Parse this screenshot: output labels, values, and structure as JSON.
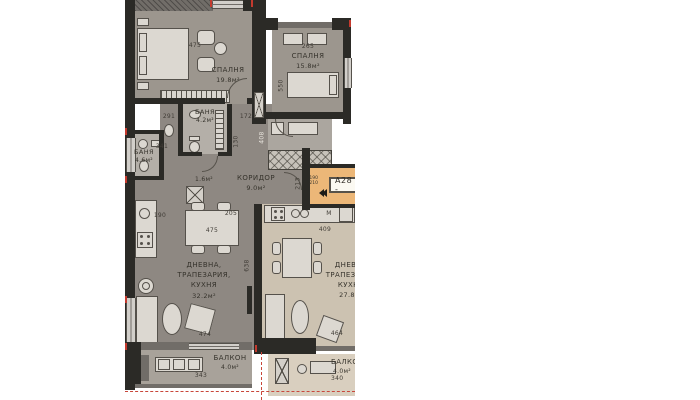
{
  "unit": {
    "badge": "А28 -",
    "entry_door_width": "190",
    "entry_door_height": "210"
  },
  "rooms": {
    "bedroom_left": {
      "name": "СПАЛНЯ",
      "area": "19.8м²"
    },
    "bedroom_right": {
      "name": "СПАЛНЯ",
      "area": "15.8м²"
    },
    "bath_top": {
      "name": "БАНЯ",
      "area": "4.2м²"
    },
    "bath_left": {
      "name": "БАНЯ",
      "area": "4.6м²"
    },
    "corridor": {
      "name": "КОРИДОР",
      "area": "9.0м²"
    },
    "closet": {
      "area": "1.6м²"
    },
    "living_left": {
      "l1": "ДНЕВНА,",
      "l2": "ТРАПЕЗАРИЯ,",
      "l3": "КУХНЯ",
      "area": "32.2м²"
    },
    "living_right": {
      "l1": "ДНЕВНА",
      "l2": "ТРАПЕЗАРИЯ",
      "l3": "КУХНЯ",
      "area": "27.8м²"
    },
    "balcony_left": {
      "name": "БАЛКОН",
      "area": "4.0м²"
    },
    "balcony_right": {
      "name": "БАЛКОН",
      "area": "4.0м²"
    }
  },
  "dimensions": {
    "bedroom_left_width": "475",
    "bedroom_left_side": "291",
    "bath_top_width": "341",
    "bath_top_right": "172",
    "bath_top_height": "130",
    "bedroom_right_width": "265",
    "bedroom_right_height": "550",
    "shaft_height": "408",
    "hall_width": "205",
    "hall_height": "213",
    "kitchen_left": "190",
    "dining_table_left": "475",
    "living_left_height": "638",
    "living_left_width": "474",
    "balcony_left_width": "343",
    "kitchen_right_width": "409",
    "living_right_width": "464",
    "balcony_right_width": "340"
  },
  "labels": {
    "fridge": "М"
  },
  "colors": {
    "wall": "#2b2a26",
    "floor_grey": "#8e8882",
    "floor_bedroom": "#9c968e",
    "floor_bath": "#b4afa8",
    "floor_right": "#ccc2b1",
    "balcony_right": "#d9cfbf",
    "entry_bg": "#ecb778",
    "accent_red": "#c8463a"
  }
}
